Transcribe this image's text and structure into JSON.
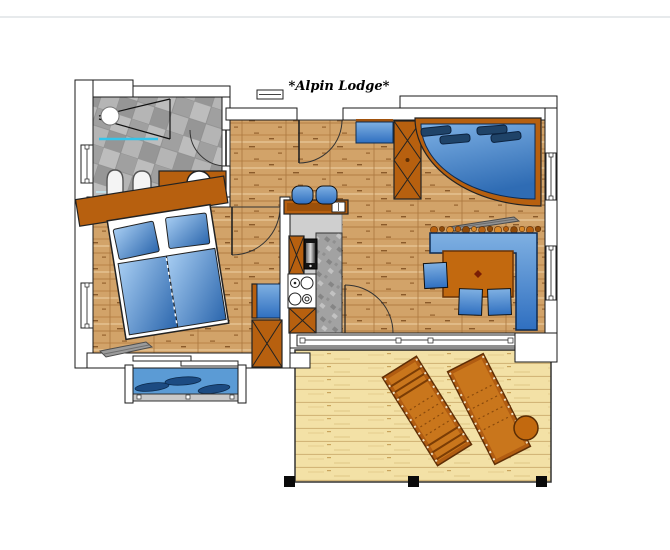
{
  "title": "*Alpin Lodge*",
  "plan": {
    "rooms": [
      "bathroom",
      "bedroom",
      "hall",
      "kitchen",
      "living-dining-room",
      "balcony",
      "terrace"
    ],
    "furniture": [
      "shower",
      "toilet",
      "bidet",
      "washbasin-vanity",
      "double-bed",
      "bedroom-wardrobe",
      "bar-counter",
      "bar-stools",
      "stove",
      "oven",
      "kitchen-cabinets",
      "curved-sofa",
      "living-wardrobe",
      "sideboard",
      "dining-corner-bench",
      "dining-table",
      "dining-chairs",
      "sun-lounger",
      "sun-lounger",
      "terrace-side-table",
      "balcony-cushions",
      "skis"
    ]
  },
  "colors": {
    "furniture_brown": "#b7600f",
    "water_blue": "#4a90d9",
    "deep_navy": "#1f4368",
    "tile_gray": "#ababab",
    "wood_tan": "#d2a369",
    "deck_sand": "#f3e1a6",
    "outline": "#1a1a1a",
    "shower_line": "#35c4ea"
  }
}
